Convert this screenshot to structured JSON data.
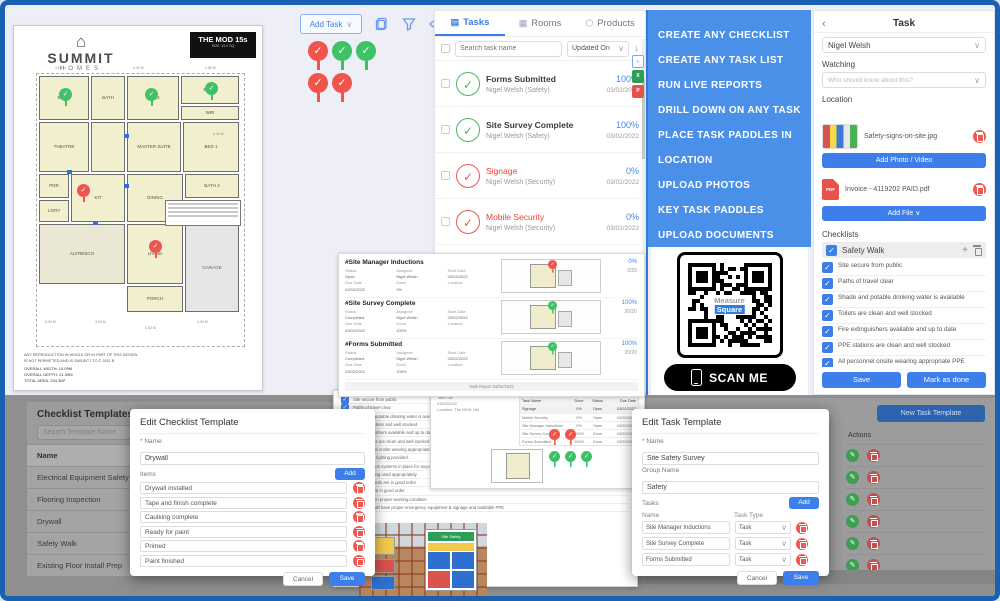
{
  "colors": {
    "accent": "#3d7eea",
    "banner_bg": "#4a90e8",
    "red": "#ee564e",
    "green": "#49b85b",
    "frame": "#1b61b3"
  },
  "floorplan": {
    "brand_icon": "⌂",
    "brand": "SUMMIT",
    "brand_sub": "HOMES",
    "title": "THE MOD 15s",
    "subtitle": "SIZE: 15.0 SQ",
    "rooms": [
      {
        "x": 2,
        "y": 2,
        "w": 50,
        "h": 44,
        "label": "BED 3"
      },
      {
        "x": 54,
        "y": 2,
        "w": 34,
        "h": 44,
        "label": "BATH"
      },
      {
        "x": 90,
        "y": 2,
        "w": 52,
        "h": 44,
        "label": "BED 2"
      },
      {
        "x": 144,
        "y": 2,
        "w": 58,
        "h": 28,
        "label": "ENS 1"
      },
      {
        "x": 144,
        "y": 32,
        "w": 58,
        "h": 14,
        "label": "WIR"
      },
      {
        "x": 2,
        "y": 48,
        "w": 50,
        "h": 50,
        "label": "THEATRE"
      },
      {
        "x": 54,
        "y": 48,
        "w": 34,
        "h": 50,
        "label": ""
      },
      {
        "x": 90,
        "y": 48,
        "w": 54,
        "h": 50,
        "label": "MASTER SUITE"
      },
      {
        "x": 146,
        "y": 48,
        "w": 56,
        "h": 50,
        "label": "BED 1"
      },
      {
        "x": 2,
        "y": 100,
        "w": 30,
        "h": 24,
        "label": "PDR"
      },
      {
        "x": 2,
        "y": 126,
        "w": 30,
        "h": 22,
        "label": "L'DRY"
      },
      {
        "x": 34,
        "y": 100,
        "w": 54,
        "h": 48,
        "label": "KIT"
      },
      {
        "x": 90,
        "y": 100,
        "w": 56,
        "h": 48,
        "label": "DINING"
      },
      {
        "x": 148,
        "y": 100,
        "w": 54,
        "h": 24,
        "label": "BATH 2"
      },
      {
        "x": 2,
        "y": 150,
        "w": 86,
        "h": 60,
        "label": "ALFRESCO",
        "cls": "alf"
      },
      {
        "x": 90,
        "y": 150,
        "w": 56,
        "h": 60,
        "label": "LIVING"
      },
      {
        "x": 148,
        "y": 126,
        "w": 54,
        "h": 22,
        "label": "WC"
      },
      {
        "x": 148,
        "y": 150,
        "w": 54,
        "h": 88,
        "label": "GARAGE",
        "cls": "garage"
      },
      {
        "x": 90,
        "y": 212,
        "w": 56,
        "h": 26,
        "label": "PORCH"
      }
    ],
    "dims": [
      {
        "x": 8,
        "y": 246,
        "t": "5.32 M"
      },
      {
        "x": 58,
        "y": 246,
        "t": "3.24 M"
      },
      {
        "x": 108,
        "y": 252,
        "t": "5.52 M"
      },
      {
        "x": 160,
        "y": 246,
        "t": "3.03 M"
      },
      {
        "x": 176,
        "y": 58,
        "t": "3.26 M"
      },
      {
        "x": 18,
        "y": -8,
        "t": "3.62 M"
      },
      {
        "x": 96,
        "y": -8,
        "t": "3.40 M"
      },
      {
        "x": 168,
        "y": -8,
        "t": "1.85 M"
      }
    ],
    "pins": [
      {
        "x": 22,
        "y": 14,
        "cls": "green"
      },
      {
        "x": 108,
        "y": 14,
        "cls": "green"
      },
      {
        "x": 168,
        "y": 8,
        "cls": "green"
      },
      {
        "x": 40,
        "y": 110,
        "cls": "red"
      },
      {
        "x": 112,
        "y": 166,
        "cls": "red"
      }
    ],
    "markers": [
      {
        "x": 87,
        "y": 60
      },
      {
        "x": 87,
        "y": 110
      },
      {
        "x": 56,
        "y": 147
      },
      {
        "x": 30,
        "y": 96
      }
    ],
    "totals": [
      "OVERALL WIDTH: 10.09M",
      "OVERALL DEPTH: 21.39M",
      "TOTAL AREA: 204.3M²"
    ],
    "disclaimer": [
      "ANY REPRODUCTION IN WHOLE OR IN PART OF THIS DESIGN",
      "IS NOT PERMITTED AND IS SUBJECT TO © 2011 B"
    ]
  },
  "toolbar": {
    "add_task": "Add Task"
  },
  "paddles": [
    {
      "x": 303,
      "y": 36,
      "cls": "red"
    },
    {
      "x": 327,
      "y": 36,
      "cls": "green"
    },
    {
      "x": 351,
      "y": 36,
      "cls": "green"
    },
    {
      "x": 303,
      "y": 68,
      "cls": "red"
    },
    {
      "x": 327,
      "y": 68,
      "cls": "red"
    }
  ],
  "task_panel": {
    "tabs": [
      {
        "label": "Tasks",
        "cls": "active",
        "icon": "▤"
      },
      {
        "label": "Rooms",
        "cls": "",
        "icon": "▦"
      },
      {
        "label": "Products",
        "cls": "",
        "icon": "⬡"
      }
    ],
    "search_placeholder": "Search task name",
    "sort_value": "Updated On",
    "tasks": [
      {
        "title": "Forms Submitted",
        "assignee": "Nigel Welsh (Safety)",
        "pct": "100%",
        "date": "03/02/2022",
        "cls": "g",
        "tcls": ""
      },
      {
        "title": "Site Survey Complete",
        "assignee": "Nigel Welsh (Safety)",
        "pct": "100%",
        "date": "03/02/2022",
        "cls": "g",
        "tcls": ""
      },
      {
        "title": "Signage",
        "assignee": "Nigel Welsh (Security)",
        "pct": "0%",
        "date": "03/02/2022",
        "cls": "r",
        "tcls": "red-t"
      },
      {
        "title": "Mobile Security",
        "assignee": "Nigel Welsh (Security)",
        "pct": "0%",
        "date": "03/02/2022",
        "cls": "r",
        "tcls": "red-t"
      },
      {
        "title": "Site Manager Inductions",
        "assignee": "Nigel Welsh (Safety)",
        "pct": "0%",
        "date": "03/02/2022",
        "cls": "r",
        "tcls": "red-t"
      },
      {
        "title": "Bdrm #4",
        "assignee": "Nigel Welsh (Carpet Installation GJ7)",
        "pct": "25%",
        "date": "11/23/2020",
        "cls": "room",
        "tcls": "red-t"
      },
      {
        "title": "KIT LIV/DIN",
        "assignee": "Nigel Welsh (Carpet Installation GJ7)",
        "pct": "25%",
        "date": "11/23/2020",
        "cls": "room",
        "tcls": "red-t"
      }
    ]
  },
  "banner": {
    "lines": [
      "CREATE ANY CHECKLIST",
      "CREATE ANY TASK LIST",
      "RUN LIVE REPORTS",
      "DRILL DOWN ON ANY TASK",
      "PLACE TASK PADDLES IN",
      "LOCATION",
      "UPLOAD PHOTOS",
      "KEY TASK PADDLES",
      "UPLOAD DOCUMENTS"
    ]
  },
  "qr": {
    "center_top": "Measure",
    "center_bottom": "Square",
    "scan_label": "SCAN ME"
  },
  "task_detail": {
    "back": "‹",
    "title": "Task",
    "assignee_value": "Nigel Welsh",
    "watching_label": "Watching",
    "watching_placeholder": "Who should know about this?",
    "location_label": "Location",
    "photo_name": "Safety-signs-on-site.jpg",
    "add_photo": "Add Photo / Video",
    "file_name": "Invoice - 4119202 PAID.pdf",
    "add_file": "Add File ∨",
    "checklists_label": "Checklists",
    "checklist_name": "Safety Walk",
    "plus": "+",
    "items": [
      "Site secure from public",
      "Paths of travel clear",
      "Shade and potable drinking water is available",
      "Toilets are clean and well stocked",
      "Fire extinguishers available and up to date",
      "PPE stations are clean and well stocked",
      "All personnel onsite wearing appropriate PPE",
      "Appropriate lighting provided.",
      "Fall protection systems in place for anyone who could fall over 6 feet.",
      "Ladders being used appropriately"
    ],
    "save": "Save",
    "mark_done": "Mark as done"
  },
  "report_top": {
    "labels": {
      "status": "Status",
      "assignee": "Assignee",
      "start": "Start Date",
      "due": "Due Date",
      "done": "Done",
      "location": "Location"
    },
    "sections": [
      {
        "title": "#Site Manager Inductions",
        "status_v": "Open",
        "assignee_v": "Nigel Welsh",
        "start_v": "03/02/2022",
        "due_v": "03/02/2022",
        "done_v": "0%",
        "pct": "0%",
        "frac": "0/20",
        "cls": "red"
      },
      {
        "title": "#Site Survey Complete",
        "status_v": "Completed",
        "assignee_v": "Nigel Welsh",
        "start_v": "03/02/2022",
        "due_v": "03/02/2022",
        "done_v": "100%",
        "pct": "100%",
        "frac": "20/20",
        "cls": "green"
      },
      {
        "title": "#Forms Submitted",
        "status_v": "Completed",
        "assignee_v": "Nigel Welsh",
        "start_v": "03/02/2022",
        "due_v": "03/02/2022",
        "done_v": "100%",
        "pct": "100%",
        "frac": "20/20",
        "cls": "green"
      }
    ],
    "footer": "Task Report   03/02/2022"
  },
  "templates_panel": {
    "title": "Checklist Templates",
    "search_placeholder": "Search Template Name",
    "rows": [
      {
        "label": "Name",
        "cls": "hd"
      },
      {
        "label": "Electrical Equipment Safety Inspections",
        "cls": ""
      },
      {
        "label": "Flooring Inspection",
        "cls": ""
      },
      {
        "label": "Drywall",
        "cls": ""
      },
      {
        "label": "Safety Walk",
        "cls": ""
      },
      {
        "label": "Existing Floor Install Prep",
        "cls": ""
      }
    ]
  },
  "right_panel": {
    "new_btn": "New Task Template",
    "actions_header": "Actions",
    "action_rows": [
      1,
      2,
      3,
      4,
      5,
      6
    ]
  },
  "edit_checklist": {
    "title": "Edit Checklist Template",
    "name_label": "Name",
    "req": "*",
    "name_value": "Drywall",
    "items_label": "Items",
    "add": "Add",
    "items": [
      "Drywall installed",
      "Tape and finish complete",
      "Caulking complete",
      "Ready for paint",
      "Primed",
      "Paint finished"
    ],
    "cancel": "Cancel",
    "save": "Save"
  },
  "edit_task": {
    "title": "Edit Task Template",
    "name_label": "Name",
    "req": "*",
    "name_value": "Site Safety Survey",
    "group_label": "Group Name",
    "group_value": "Safety",
    "tasks_label": "Tasks",
    "add": "Add",
    "col_name": "Name",
    "col_type": "Task Type",
    "rows": [
      {
        "name": "Site Manager Inductions",
        "type": "Task"
      },
      {
        "name": "Site Survey Complete",
        "type": "Task"
      },
      {
        "name": "Forms Submitted",
        "type": "Task"
      }
    ],
    "cancel": "Cancel",
    "save": "Save"
  },
  "page_a": {
    "items": [
      "Site secure from public",
      "Paths of travel clear",
      "Shade and potable drinking water is available",
      "Toilets are clean and well stocked",
      "Fire extinguishers available and up to date",
      "PPE stations are clean and well stocked",
      "All personnel onsite wearing appropriate PPE",
      "Appropriate lighting provided.",
      "Fall protection systems in place for anyone who could fall over 6 feet.",
      "Ladders being used appropriately",
      "Electrical cords are in good order",
      "Air hoses are in good order",
      "Scaffolding in proper working condition",
      "All onsite staff have proper emergency equipment & signage and available PPE"
    ],
    "photos_label": "Photos",
    "photo_caption": "Safety-signs-on-site.jpg",
    "sign_header": "Site Safety"
  },
  "page_b": {
    "meta": [
      "Task List",
      "03/02/2022",
      "Location: The MOD 15s"
    ],
    "header": {
      "c1": "Task Name",
      "c2": "Done",
      "c3": "Status",
      "c4": "Due Date"
    },
    "rows": [
      {
        "c1": "Signage",
        "c2": "0%",
        "c3": "Open",
        "c4": "03/02/2022"
      },
      {
        "c1": "Mobile Security",
        "c2": "0%",
        "c3": "Open",
        "c4": "03/02/2022"
      },
      {
        "c1": "Site Manager Inductions",
        "c2": "0%",
        "c3": "Open",
        "c4": "03/02/2022"
      },
      {
        "c1": "Site Survey Complete",
        "c2": "100%",
        "c3": "Done",
        "c4": "03/02/2022"
      },
      {
        "c1": "Forms Submitted",
        "c2": "100%",
        "c3": "Done",
        "c4": "03/02/2022"
      }
    ],
    "pins": [
      {
        "x": 0,
        "y": 0,
        "cls": "red"
      },
      {
        "x": 16,
        "y": 0,
        "cls": "red"
      },
      {
        "x": 0,
        "y": 22,
        "cls": "green"
      },
      {
        "x": 16,
        "y": 22,
        "cls": "green"
      },
      {
        "x": 32,
        "y": 22,
        "cls": "green"
      }
    ]
  }
}
